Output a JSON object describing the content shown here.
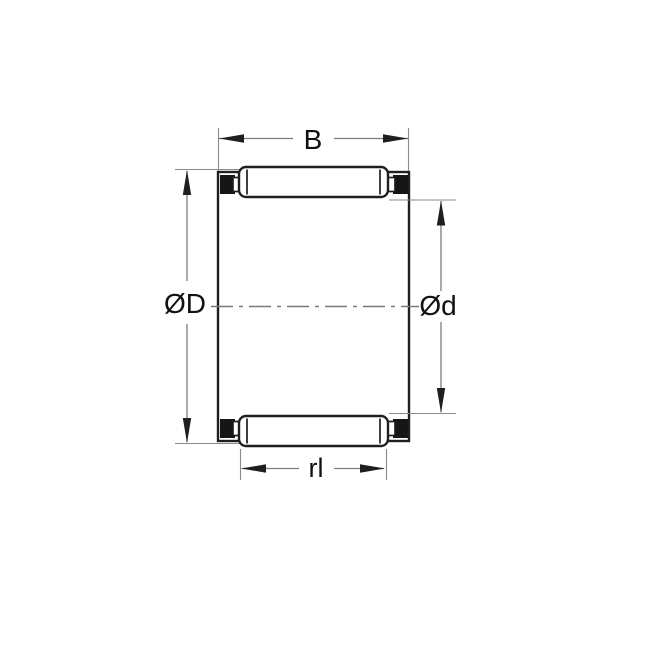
{
  "drawing": {
    "dimension_labels": {
      "width": "B",
      "outer_diameter": "ØD",
      "bore_diameter": "Ød",
      "roller_length": "rl"
    },
    "colors": {
      "background": "#ffffff",
      "geometry_line": "#1f1f1f",
      "cage_block_fill": "#161616",
      "dimension_line": "#7d7d7d",
      "extension_line": "#8a8a8a",
      "center_line": "#7a7a7a",
      "label_text": "#111111"
    }
  }
}
